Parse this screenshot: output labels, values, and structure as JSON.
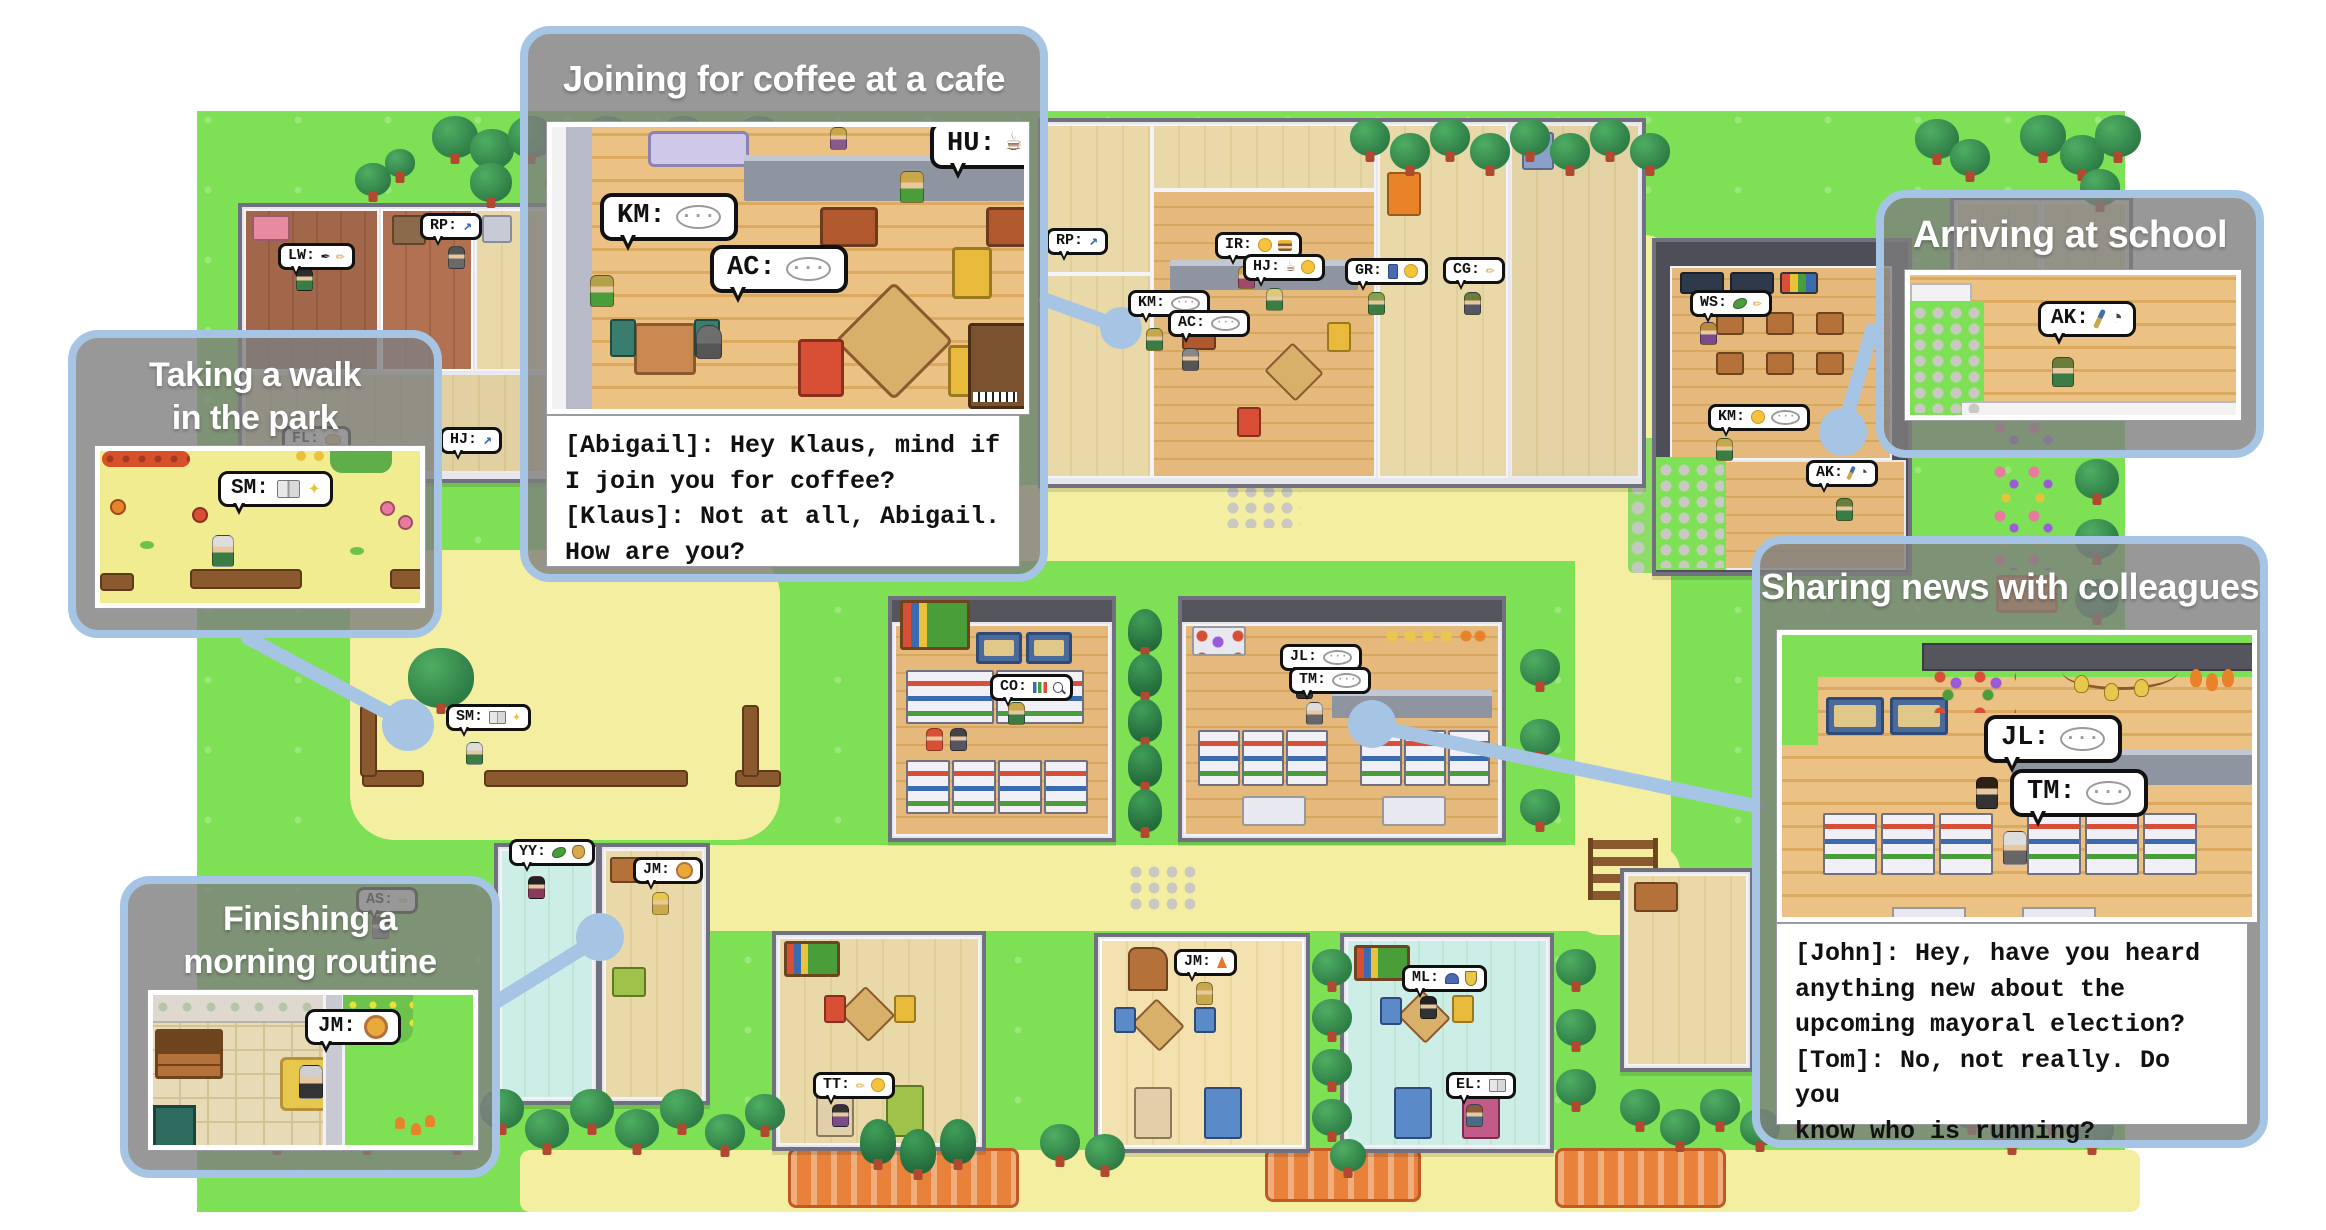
{
  "panels": {
    "coffee": {
      "title": "Joining for coffee at a cafe",
      "dialogue": "[Abigail]: Hey Klaus, mind if\nI join you for coffee?\n[Klaus]: Not at all, Abigail.\nHow are you?",
      "bubbles": [
        {
          "label": "KM:",
          "icons": [
            "chat"
          ]
        },
        {
          "label": "AC:",
          "icons": [
            "chat"
          ]
        },
        {
          "label": "HU:",
          "icons": [
            "coffee"
          ]
        }
      ]
    },
    "school": {
      "title": "Arriving at school",
      "bubbles": [
        {
          "label": "AK:",
          "icons": [
            "brush",
            "clock"
          ]
        }
      ]
    },
    "walk": {
      "title": "Taking a walk\nin the park",
      "bubbles": [
        {
          "label": "SM:",
          "icons": [
            "book",
            "sparkle"
          ]
        }
      ]
    },
    "morning": {
      "title": "Finishing a\nmorning routine",
      "bubbles": [
        {
          "label": "JM:",
          "icons": [
            "lion"
          ]
        }
      ]
    },
    "sharing": {
      "title": "Sharing news with colleagues",
      "dialogue": "[John]: Hey, have you heard\nanything new about the\nupcoming mayoral election?\n[Tom]: No, not really. Do you\nknow who is running?",
      "bubbles": [
        {
          "label": "JL:",
          "icons": [
            "chat"
          ]
        },
        {
          "label": "TM:",
          "icons": [
            "chat"
          ]
        }
      ]
    }
  },
  "map_bubbles": [
    {
      "label": "LW:",
      "icons": [
        "ink",
        "pen"
      ],
      "x": 278,
      "y": 243
    },
    {
      "label": "RP:",
      "icons": [
        "trend"
      ],
      "x": 420,
      "y": 213
    },
    {
      "label": "FL:",
      "icons": [
        "bread"
      ],
      "x": 282,
      "y": 426
    },
    {
      "label": "HJ:",
      "icons": [
        "trend"
      ],
      "x": 440,
      "y": 427
    },
    {
      "label": "RP:",
      "icons": [
        "trend"
      ],
      "x": 1046,
      "y": 228
    },
    {
      "label": "IR:",
      "icons": [
        "face",
        "burger"
      ],
      "x": 1215,
      "y": 232
    },
    {
      "label": "HJ:",
      "icons": [
        "coffee",
        "face"
      ],
      "x": 1243,
      "y": 254
    },
    {
      "label": "KM:",
      "icons": [
        "chat"
      ],
      "x": 1128,
      "y": 290
    },
    {
      "label": "AC:",
      "icons": [
        "chat"
      ],
      "x": 1168,
      "y": 310
    },
    {
      "label": "GR:",
      "icons": [
        "phone",
        "face"
      ],
      "x": 1345,
      "y": 258
    },
    {
      "label": "CG:",
      "icons": [
        "pen"
      ],
      "x": 1443,
      "y": 257
    },
    {
      "label": "WS:",
      "icons": [
        "leaf",
        "pen"
      ],
      "x": 1690,
      "y": 290
    },
    {
      "label": "KM:",
      "icons": [
        "face",
        "chat"
      ],
      "x": 1708,
      "y": 404
    },
    {
      "label": "AK:",
      "icons": [
        "brush",
        "clock"
      ],
      "x": 1806,
      "y": 460
    },
    {
      "label": "SM:",
      "icons": [
        "book",
        "sparkle"
      ],
      "x": 446,
      "y": 704
    },
    {
      "label": "YY:",
      "icons": [
        "leaf",
        "money"
      ],
      "x": 509,
      "y": 839
    },
    {
      "label": "JM:",
      "icons": [
        "lion"
      ],
      "x": 633,
      "y": 857
    },
    {
      "label": "AS:",
      "icons": [
        "pen"
      ],
      "x": 356,
      "y": 887
    },
    {
      "label": "CO:",
      "icons": [
        "bars",
        "mag"
      ],
      "x": 990,
      "y": 674
    },
    {
      "label": "JL:",
      "icons": [
        "chat"
      ],
      "x": 1280,
      "y": 644
    },
    {
      "label": "TM:",
      "icons": [
        "chat"
      ],
      "x": 1289,
      "y": 667
    },
    {
      "label": "TT:",
      "icons": [
        "pen",
        "face"
      ],
      "x": 813,
      "y": 1072
    },
    {
      "label": "JM:",
      "icons": [
        "fire"
      ],
      "x": 1174,
      "y": 949
    },
    {
      "label": "ML:",
      "icons": [
        "cap",
        "shield"
      ],
      "x": 1402,
      "y": 965
    },
    {
      "label": "EL:",
      "icons": [
        "book"
      ],
      "x": 1446,
      "y": 1072
    }
  ],
  "colors": {
    "panel_border": "#a6c4e4",
    "panel_gray": "#7e7e7e",
    "map_green": "#7ee055",
    "path_yellow": "#f4efa0"
  }
}
